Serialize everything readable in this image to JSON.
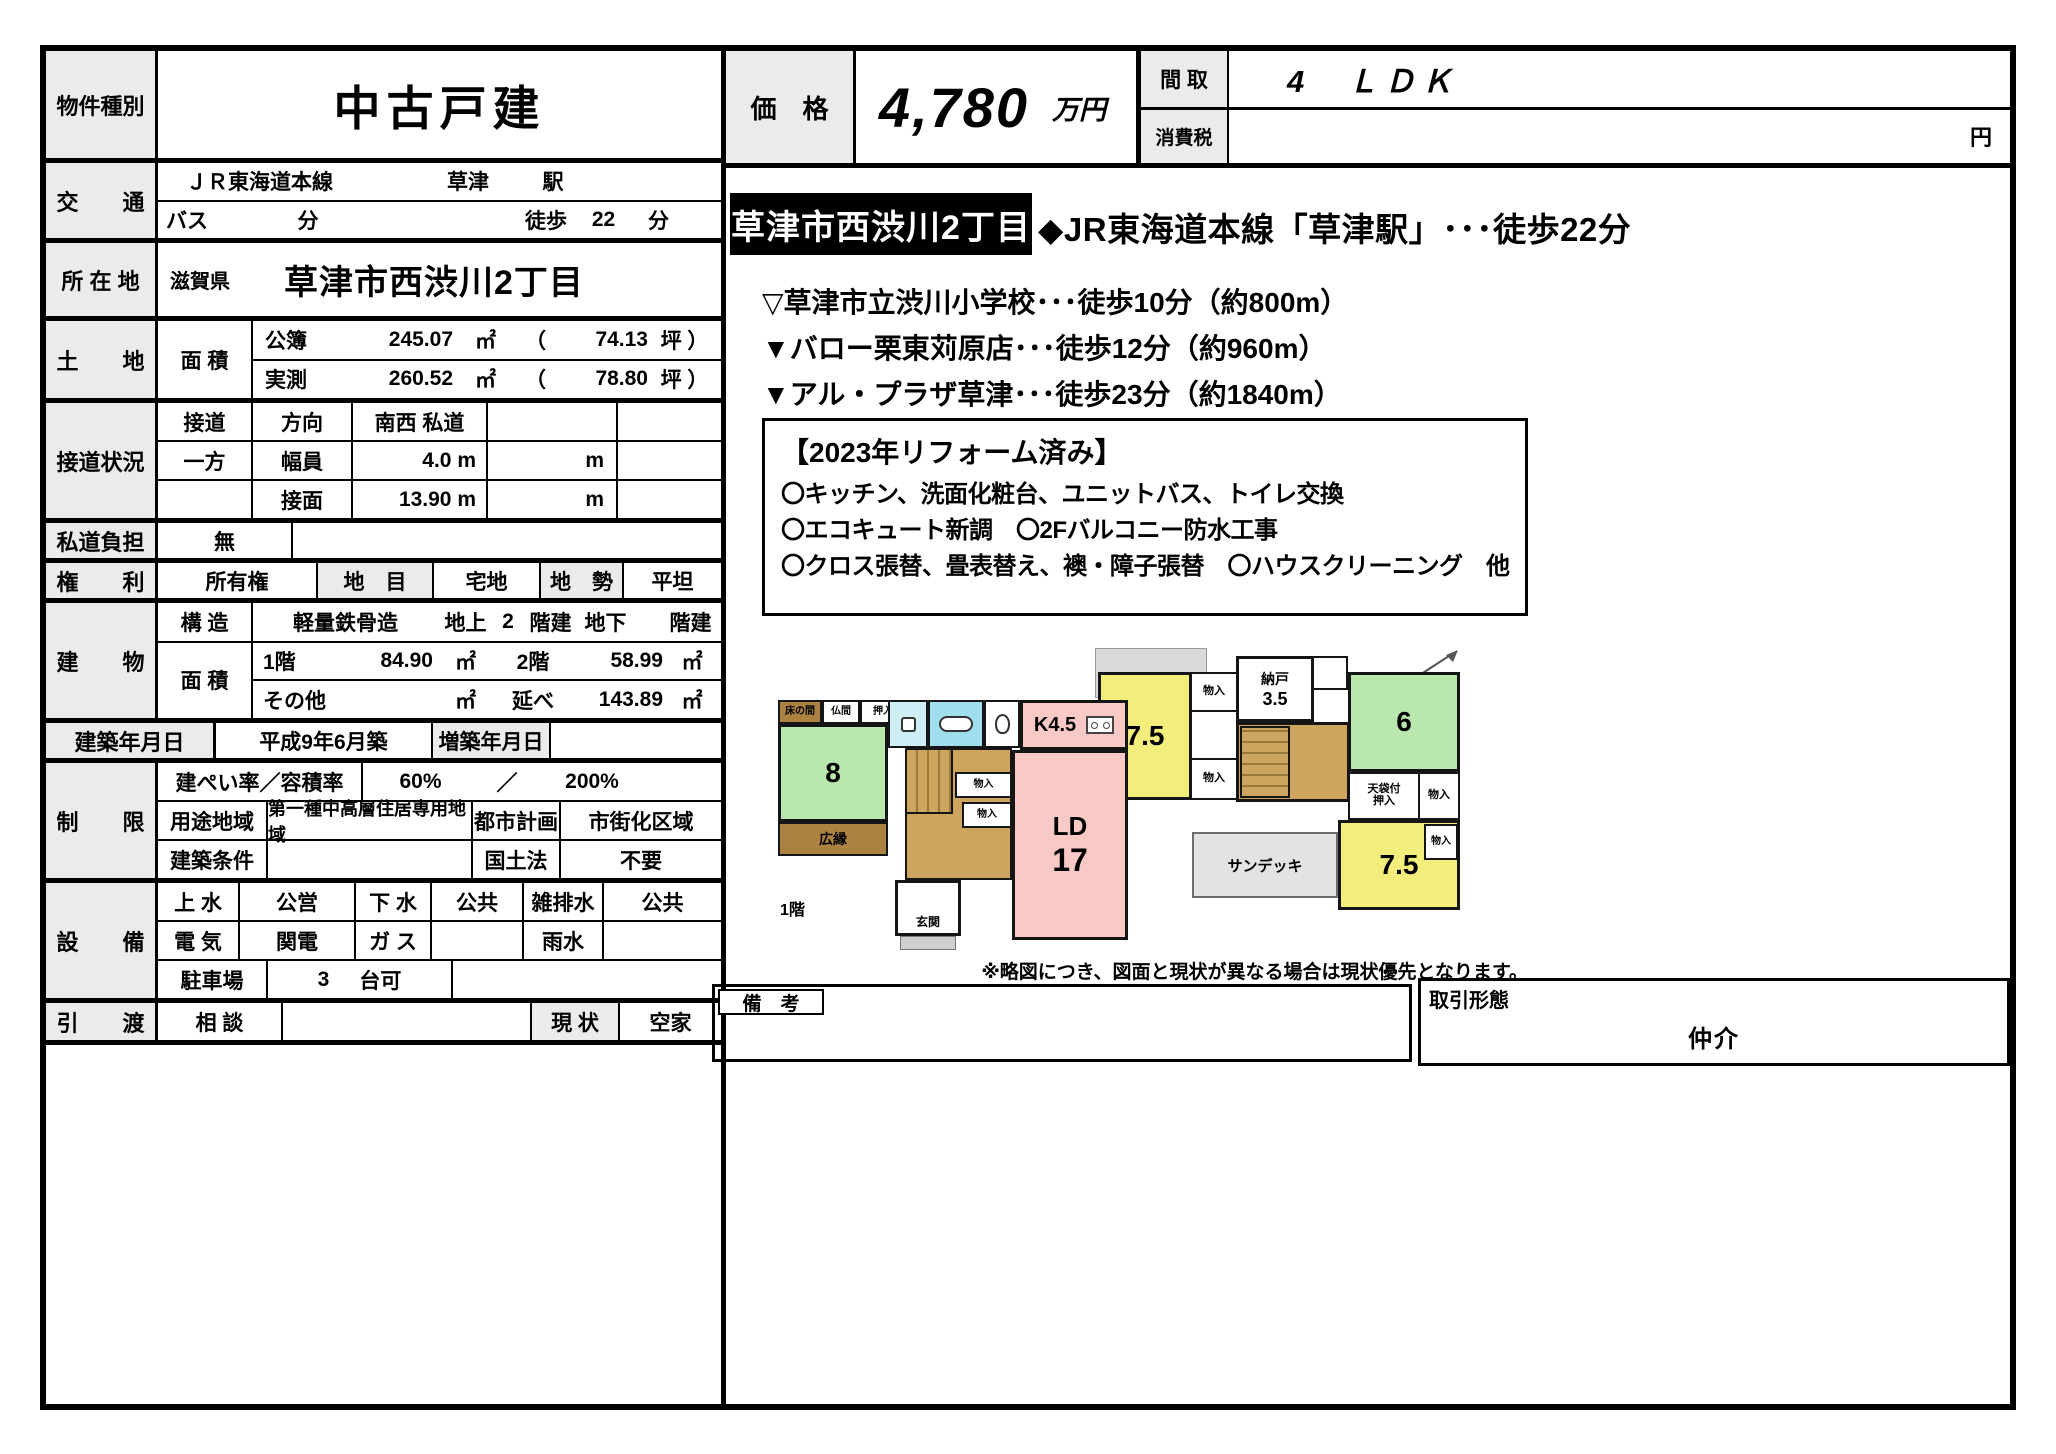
{
  "header": {
    "property_type_label": "物件種別",
    "property_type_value": "中古戸建",
    "price_label": "価　格",
    "price_value": "4,780",
    "price_unit": "万円",
    "madori_label": "間 取",
    "madori_value": "4　ＬＤＫ",
    "tax_label": "消費税",
    "tax_unit": "円"
  },
  "spec": {
    "access": {
      "label": "交　　通",
      "rail_line": "ＪＲ東海道本線",
      "station": "草津",
      "station_suffix": "駅",
      "bus_label": "バス",
      "bus_unit": "分",
      "walk_label": "徒歩",
      "walk_value": "22",
      "walk_unit": "分"
    },
    "location": {
      "label": "所 在 地",
      "prefecture": "滋賀県",
      "address": "草津市西渋川2丁目"
    },
    "land": {
      "label": "土　　地",
      "area_label": "面 積",
      "registered_label": "公簿",
      "registered_value": "245.07",
      "registered_unit": "㎡",
      "registered_paren": "（",
      "registered_tsubo": "74.13",
      "registered_tsubo_unit": "坪 ）",
      "measured_label": "実測",
      "measured_value": "260.52",
      "measured_unit": "㎡",
      "measured_paren": "（",
      "measured_tsubo": "78.80",
      "measured_tsubo_unit": "坪 ）"
    },
    "road": {
      "label": "接道状況",
      "contact_label": "接道",
      "direction_label": "方向",
      "direction_value": "南西 私道",
      "oneside_label": "一方",
      "width_label": "幅員",
      "width_value": "4.0 m",
      "frontage_label": "接面",
      "frontage_value": "13.90 m",
      "unit_m": "m"
    },
    "private_road": {
      "label": "私道負担",
      "value": "無"
    },
    "rights": {
      "label": "権　　利",
      "value": "所有権",
      "category_label": "地　目",
      "category_value": "宅地",
      "terrain_label": "地　勢",
      "terrain_value": "平坦"
    },
    "building": {
      "label": "建　　物",
      "structure_label": "構 造",
      "structure_value": "軽量鉄骨造",
      "above_label": "地上",
      "above_value": "2",
      "above_unit": "階建",
      "below_label": "地下",
      "below_unit": "階建",
      "area_label": "面 積",
      "f1_label": "1階",
      "f1_value": "84.90",
      "f1_unit": "㎡",
      "f2_label": "2階",
      "f2_value": "58.99",
      "f2_unit": "㎡",
      "other_label": "その他",
      "other_unit": "㎡",
      "total_label": "延べ",
      "total_value": "143.89",
      "total_unit": "㎡"
    },
    "built": {
      "label": "建築年月日",
      "value": "平成9年6月築",
      "extension_label": "増築年月日"
    },
    "limits": {
      "label": "制　　限",
      "coverage_label": "建ぺい率／容積率",
      "coverage_value": "60%",
      "slash": "／",
      "volume_value": "200%",
      "zoning_label": "用途地域",
      "zoning_value": "第一種中高層住居専用地域",
      "cityplan_label": "都市計画",
      "cityplan_value": "市街化区域",
      "condition_label": "建築条件",
      "kokudo_label": "国土法",
      "kokudo_value": "不要"
    },
    "utilities": {
      "label": "設　　備",
      "water_label": "上 水",
      "water_value": "公営",
      "sewer_label": "下 水",
      "sewer_value": "公共",
      "drain_label": "雑排水",
      "drain_value": "公共",
      "electric_label": "電 気",
      "electric_value": "関電",
      "gas_label": "ガ ス",
      "rain_label": "雨水",
      "parking_label": "駐車場",
      "parking_value": "3",
      "parking_unit": "台可"
    },
    "handover": {
      "label": "引　　渡",
      "value": "相 談",
      "status_label": "現 状",
      "status_value": "空家"
    }
  },
  "highlight": {
    "address_badge": "草津市西渋川2丁目",
    "station_line": "◆JR東海道本線「草津駅」･･･徒歩22分",
    "poi1": "▽草津市立渋川小学校･･･徒歩10分（約800m）",
    "poi2": "▼バロー栗東苅原店･･･徒歩12分（約960m）",
    "poi3": "▼アル・プラザ草津･･･徒歩23分（約1840m）",
    "reform_title": "【2023年リフォーム済み】",
    "reform_line1": "〇キッチン、洗面化粧台、ユニットバス、トイレ交換",
    "reform_line2": "〇エコキュート新調　〇2Fバルコニー防水工事",
    "reform_line3": "〇クロス張替、畳表替え、襖・障子張替　〇ハウスクリーニング　他"
  },
  "plan2f": {
    "room_75a": "7.5",
    "closet": "物入",
    "storage_label": "納戸",
    "storage_size": "3.5",
    "room_6": "6",
    "tenbukuro_line1": "天袋付",
    "tenbukuro_line2": "押入",
    "room_75b": "7.5",
    "sun_deck": "サンデッキ",
    "floor_label": "2階"
  },
  "plan1f": {
    "tokonoma": "床の間",
    "butsuma": "仏間",
    "oshiire": "押入",
    "room_8": "8",
    "hiroen": "広縁",
    "kitchen": "K4.5",
    "ld": "LD",
    "ld_size": "17",
    "closet": "物入",
    "genkan": "玄関",
    "floor_label": "1階"
  },
  "footer": {
    "disclaimer": "※略図につき、図面と現状が異なる場合は現状優先となります。",
    "remarks_label": "備　考",
    "transaction_label": "取引形態",
    "transaction_value": "仲介"
  }
}
